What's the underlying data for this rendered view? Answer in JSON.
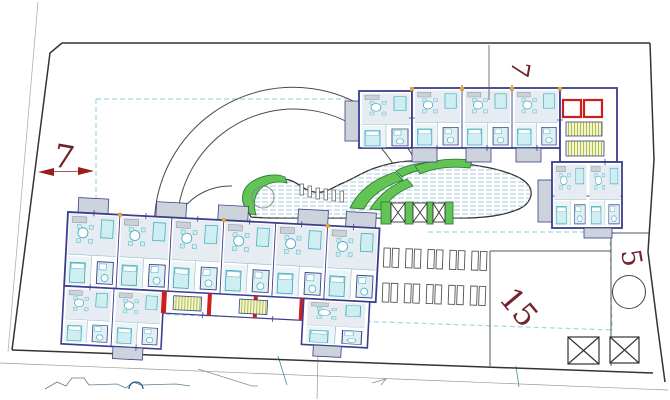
{
  "drawing": {
    "title": "residential site plan",
    "labels": {
      "left_setback": "7",
      "top_setback": "7",
      "area_15": "15",
      "area_5": "5"
    },
    "colors": {
      "wall_navy": "#3b3e8c",
      "furniture_teal": "#2fa8bb",
      "furniture_fill": "#cfeef2",
      "room_fill": "#e6ecf1",
      "balcony_gray": "#ccd3da",
      "landscape_green": "#62c455",
      "landscape_green_dark": "#2e7d32",
      "red_accent": "#cc2020",
      "dimension_red": "#9c1b1b",
      "label_maroon": "#6e2226",
      "stair_olive": "#a9b83a",
      "setback_cyan": "#9ed8e2",
      "boundary_black": "#333333",
      "terrain_blue": "#5b7f93"
    }
  }
}
